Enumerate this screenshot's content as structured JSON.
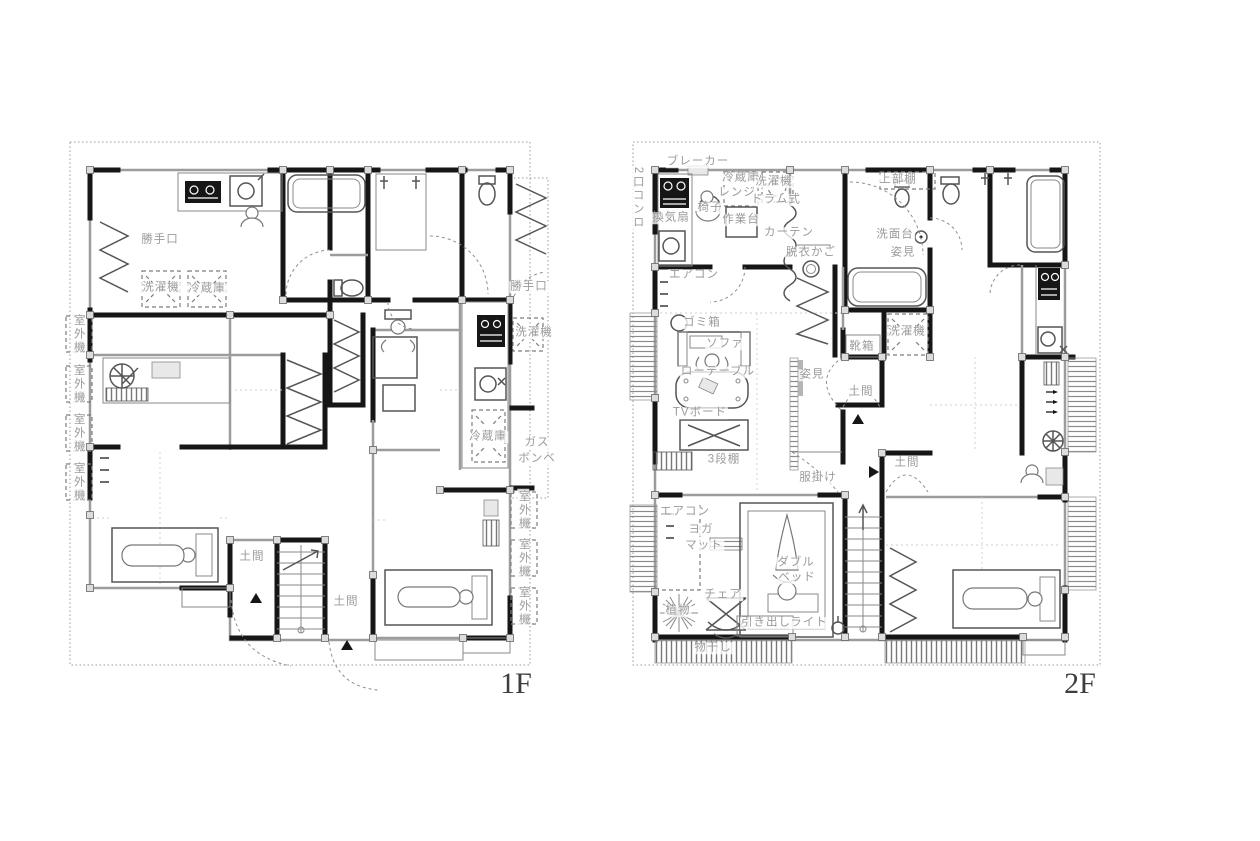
{
  "title": "House floor plan 1F / 2F",
  "colors": {
    "background": "#ffffff",
    "wall": "#161616",
    "thin_line": "#9c9c9c",
    "label_text": "#9b9b9b",
    "floor_label_text": "#3d3d3d"
  },
  "floors": [
    {
      "name_label": "1F",
      "labels": [
        {
          "t": "勝手口",
          "n": "back-door-label",
          "x": 160,
          "y": 240
        },
        {
          "t": "洗濯機",
          "n": "washing-machine-label",
          "x": 161,
          "y": 288
        },
        {
          "t": "冷蔵庫",
          "n": "refrigerator-label",
          "x": 207,
          "y": 289
        },
        {
          "t": "室外機",
          "n": "outdoor-unit-label",
          "x": 78,
          "y": 334,
          "v": true
        },
        {
          "t": "室外機",
          "n": "outdoor-unit-label",
          "x": 78,
          "y": 384,
          "v": true
        },
        {
          "t": "室外機",
          "n": "outdoor-unit-label",
          "x": 78,
          "y": 433,
          "v": true
        },
        {
          "t": "室外機",
          "n": "outdoor-unit-label",
          "x": 78,
          "y": 482,
          "v": true
        },
        {
          "t": "勝手口",
          "n": "back-door-label",
          "x": 529,
          "y": 287
        },
        {
          "t": "洗濯機",
          "n": "washing-machine-label",
          "x": 534,
          "y": 333
        },
        {
          "t": "冷蔵庫",
          "n": "refrigerator-label",
          "x": 488,
          "y": 437
        },
        {
          "t": "ガス",
          "n": "gas-label",
          "x": 537,
          "y": 443
        },
        {
          "t": "ボンベ",
          "n": "gas-cylinder-label",
          "x": 537,
          "y": 459
        },
        {
          "t": "室外機",
          "n": "outdoor-unit-label",
          "x": 523,
          "y": 510,
          "v": true
        },
        {
          "t": "室外機",
          "n": "outdoor-unit-label",
          "x": 523,
          "y": 558,
          "v": true
        },
        {
          "t": "室外機",
          "n": "outdoor-unit-label",
          "x": 523,
          "y": 606,
          "v": true
        },
        {
          "t": "土間",
          "n": "doma-label",
          "x": 252,
          "y": 557
        },
        {
          "t": "土間",
          "n": "doma-label",
          "x": 346,
          "y": 602
        }
      ]
    },
    {
      "name_label": "2F",
      "labels": [
        {
          "t": "ブレーカー",
          "n": "breaker-label",
          "x": 698,
          "y": 162
        },
        {
          "t": "2口コンロ",
          "n": "two-burner-stove-label",
          "x": 637,
          "y": 198,
          "v": true
        },
        {
          "t": "換気扇",
          "n": "ventilation-fan-label",
          "x": 671,
          "y": 218
        },
        {
          "t": "椅子",
          "n": "chair-label",
          "x": 710,
          "y": 208
        },
        {
          "t": "冷蔵庫",
          "n": "refrigerator-label",
          "x": 741,
          "y": 178
        },
        {
          "t": "レンジ",
          "n": "microwave-label",
          "x": 737,
          "y": 193
        },
        {
          "t": "洗濯機",
          "n": "washing-machine-label",
          "x": 774,
          "y": 182
        },
        {
          "t": "ドラム式",
          "n": "drum-washer-label",
          "x": 776,
          "y": 200
        },
        {
          "t": "作業台",
          "n": "work-table-label",
          "x": 741,
          "y": 220
        },
        {
          "t": "カーテン",
          "n": "curtain-label",
          "x": 789,
          "y": 233
        },
        {
          "t": "脱衣かご",
          "n": "laundry-basket-label",
          "x": 811,
          "y": 253
        },
        {
          "t": "上部棚",
          "n": "upper-shelf-label",
          "x": 898,
          "y": 180
        },
        {
          "t": "洗面台",
          "n": "vanity-label",
          "x": 895,
          "y": 235
        },
        {
          "t": "姿見",
          "n": "mirror-label",
          "x": 903,
          "y": 253
        },
        {
          "t": "エアコン",
          "n": "air-conditioner-label",
          "x": 694,
          "y": 275
        },
        {
          "t": "ゴミ箱",
          "n": "trash-can-label",
          "x": 702,
          "y": 323
        },
        {
          "t": "ソファ",
          "n": "sofa-label",
          "x": 725,
          "y": 344
        },
        {
          "t": "ローテーブル",
          "n": "low-table-label",
          "x": 718,
          "y": 372
        },
        {
          "t": "TVボード",
          "n": "tv-board-label",
          "x": 700,
          "y": 413
        },
        {
          "t": "3段棚",
          "n": "three-tier-shelf-label",
          "x": 724,
          "y": 460
        },
        {
          "t": "洗濯機",
          "n": "washing-machine-label",
          "x": 907,
          "y": 332
        },
        {
          "t": "靴箱",
          "n": "shoe-box-label",
          "x": 862,
          "y": 347
        },
        {
          "t": "姿見",
          "n": "mirror-label",
          "x": 812,
          "y": 375
        },
        {
          "t": "土間",
          "n": "doma-label",
          "x": 861,
          "y": 392
        },
        {
          "t": "土間",
          "n": "doma-label",
          "x": 907,
          "y": 463
        },
        {
          "t": "服掛け",
          "n": "clothes-rack-label",
          "x": 818,
          "y": 478
        },
        {
          "t": "エアコン",
          "n": "air-conditioner-label",
          "x": 685,
          "y": 512
        },
        {
          "t": "ヨガ",
          "n": "yoga-label",
          "x": 701,
          "y": 530
        },
        {
          "t": "マット",
          "n": "mat-label",
          "x": 704,
          "y": 546
        },
        {
          "t": "ダブル",
          "n": "double-label",
          "x": 796,
          "y": 563
        },
        {
          "t": "ベッド",
          "n": "bed-label",
          "x": 797,
          "y": 578
        },
        {
          "t": "チェア",
          "n": "chair-label",
          "x": 723,
          "y": 595
        },
        {
          "t": "植物",
          "n": "plant-label",
          "x": 678,
          "y": 611
        },
        {
          "t": "引き出し",
          "n": "drawer-label",
          "x": 766,
          "y": 623
        },
        {
          "t": "ライト",
          "n": "light-label",
          "x": 809,
          "y": 623
        },
        {
          "t": "物干し",
          "n": "drying-rack-label",
          "x": 713,
          "y": 648
        }
      ]
    }
  ]
}
